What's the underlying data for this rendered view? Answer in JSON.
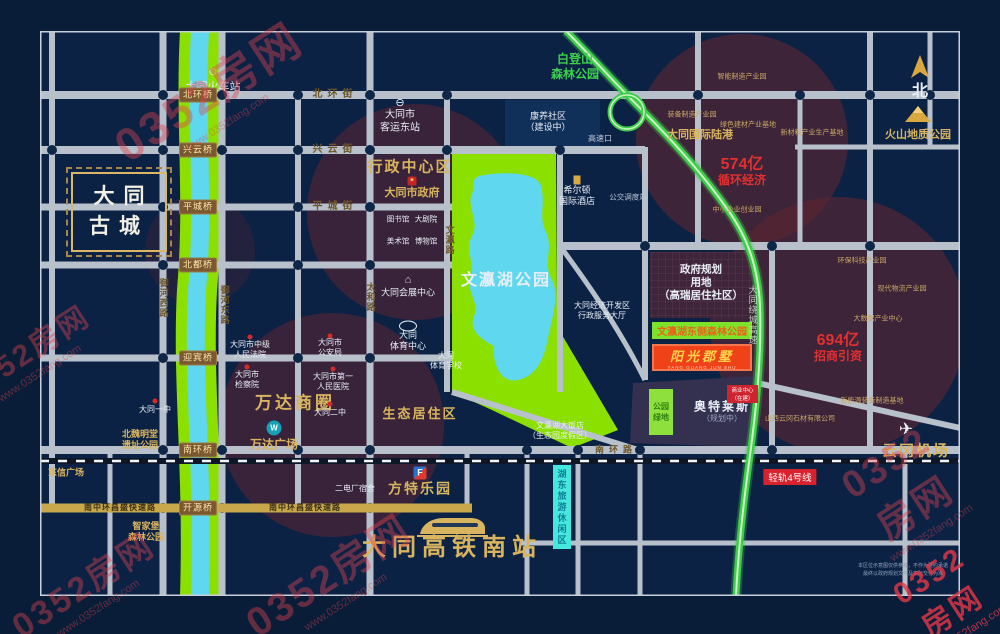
{
  "watermark": {
    "brand": "0352房网",
    "url": "www.0352fang.com"
  },
  "compass": {
    "north": "北"
  },
  "stations": {
    "railway": "大同火车站",
    "bus_east": "大同市\n客运东站",
    "hsr_south": "大同高铁南站"
  },
  "landmarks": {
    "ancient_city": "大同\n古城",
    "admin_zone": "行政中心区",
    "city_gov": "大同市政府",
    "library": "图书馆",
    "theater": "大剧院",
    "art_museum": "美术馆",
    "museum": "博物馆",
    "convention": "大同会展中心",
    "sports_center": "大同\n体育中心",
    "sports_school": "大同\n体育学校",
    "wenying_park": "文瀛湖公园",
    "eco_zone": "生态居住区",
    "wanda_zone": "万达商圈",
    "wanda_plaza": "万达广场",
    "fantawild": "方特乐园",
    "hilton": "希尔顿\n国际酒店",
    "bus_depot": "公交调度站",
    "kangyang": "康养社区\n（建设中）",
    "highway_exit": "高速口",
    "intl_port": "大同国际陆港",
    "volcano_park": "火山地质公园",
    "baideng_park": "白登山\n森林公园",
    "airport": "云冈机场",
    "court": "大同市中级\n人民法院",
    "psb": "大同市\n公安局",
    "procuratorate": "大同市\n检察院",
    "hospital": "大同市第一\n人民医院",
    "no2_school": "大同二中",
    "no1_school": "大同一中",
    "power_dorm": "二电厂宿舍",
    "dongxin_plaza": "东信广场",
    "beiwei_park": "北魏明堂\n遗址公园",
    "zhijiabu_park": "智家堡\n森林公园",
    "econ_hall": "大同经济开发区\n行政服务大厅",
    "wenying_hotel": "文瀛湖大饭店\n（生态园度假区）",
    "tourism_zone": "湖东旅游休闲区"
  },
  "project": {
    "name": "阳光郡墅",
    "pinyin": "YANG GUANG JUN SHU",
    "east_park": "文瀛湖东侧森林公园",
    "gov_planning": "政府规划\n用地\n（高瑞居住社区）",
    "outlets": "奥特莱斯",
    "outlets_note": "（规划中）",
    "green_block": "公园\n绿地",
    "red_block": "商业中心\n（在建）"
  },
  "investment": {
    "v574": "574亿",
    "v574_label": "循环经济",
    "v694": "694亿",
    "v694_label": "招商引资"
  },
  "industry": [
    "智能制造产业园",
    "装备制造产业园",
    "绿色建材产业基地",
    "新材料产业生产基地",
    "中小企业创业园",
    "环保科技产业园",
    "现代物流产业园",
    "大数据产业中心",
    "新能源装备制造基地",
    "山西云冈石材有限公司"
  ],
  "roads": {
    "beihuan": "北环街",
    "xingyun": "兴云街",
    "pingcheng": "平城街",
    "nanhuan": "南环路",
    "nanzhonghuan": "南中环昌盛快速路",
    "yuhe_west": "御河西路",
    "yuhe_east": "御河东路",
    "taihe": "太和路",
    "wenying_rd": "文瀛路",
    "ring_expwy": "大同绕城高速",
    "rail4": "轻轨4号线"
  },
  "bridges": [
    "北环桥",
    "兴云桥",
    "平城桥",
    "北都桥",
    "迎宾桥",
    "南环桥",
    "开源桥"
  ],
  "disclaimer": "本区位示意图仅供参考，不作为要约承诺\n最终以政府规划文件及实际交付为准"
}
